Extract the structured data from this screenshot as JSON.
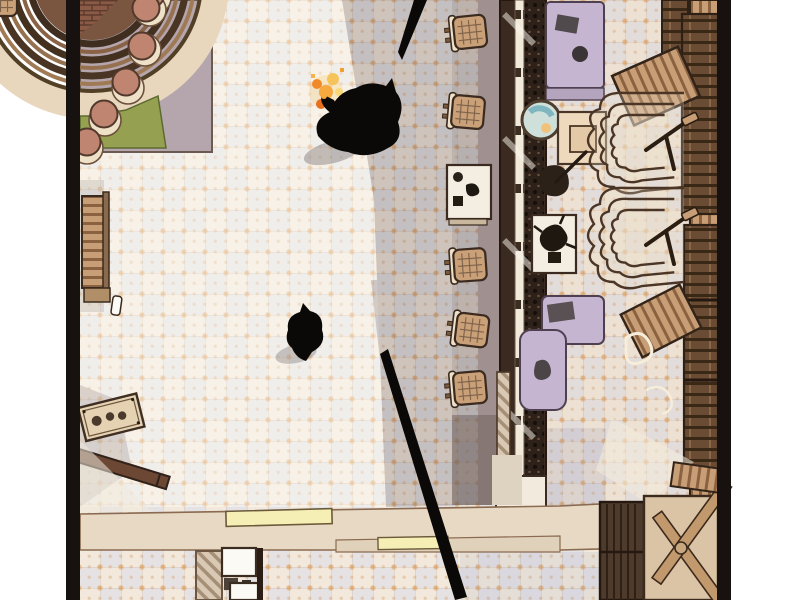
{
  "panel": {
    "alt": "Top-down comic panel of a bar interior: two black-silhouetted figures on a tiled floor, one holding a small flame, a long bar counter with stools, a curved stage with round seats, ornate armchairs, wooden benches, cabinets, and a long black pole crossing the floor"
  },
  "palette": {
    "page-bg": "#ffffff",
    "frame": "#17120f",
    "floor-base": "#f2e9dc",
    "shadow": "#685c60",
    "walkway": "#a09090",
    "carpet": "#b5a6ad",
    "green-mat": "#95a050",
    "stage-stool": "#bf8570",
    "stage-cream": "#efe0c8",
    "brick": "#8a5a46",
    "wood": "#c89e76",
    "wood-dark": "#8a623f",
    "wood-deep": "#6b4734",
    "wall-wood": "#6a4c34",
    "counter-dark": "#3a2a20",
    "counter-mid": "#2e211a",
    "counter-light": "#f1e9da",
    "stool": "#c9a078",
    "lavender": "#c6b5d0",
    "band": "#e7d9c3",
    "slat-yellow": "#f5eeb5",
    "white": "#fcfaf5",
    "ink": "#0b0907",
    "flame-orange": "#f08a28",
    "flame-yellow": "#fad87a",
    "teal": "#7fb6c0"
  },
  "scene": {
    "labels": {
      "floor": "patterned tile floor",
      "shadow": "large cast shadow across the floor",
      "stage": "curved corner stage with round stools",
      "left_bench": "slatted bench along left wall",
      "control_panel": "tilted panel with knobs",
      "plank": "fallen wooden plank",
      "bar_counter": "long bar counter with bottle rack",
      "bar_stools": "bar stools with cross-hatched seats",
      "service_table_left": "service table with kettle and cups",
      "service_table_right": "table with potted plant",
      "sink": "round basin behind the counter",
      "side_table": "square side table",
      "lavender_bench_top": "lavender banquette (top)",
      "lavender_bench_mid": "lavender banquette (middle)",
      "armchair_1": "ornate scalloped armchair",
      "armchair_2": "ornate scalloped armchair",
      "tilted_bench_1": "tilted slatted bench",
      "tilted_bench_2": "tilted slatted bench",
      "wall_cabinets": "dark wooden cabinets along right wall",
      "bottom_wall": "lower wall band with light slats",
      "light_slat_1": "pale yellow light slat",
      "light_slat_2": "pale yellow light slat",
      "hatch_door": "hatched doorway section",
      "white_panels": "white counter hatch panels",
      "slat_door": "dark slatted door",
      "xbrace_table": "cross-braced table top",
      "pole": "long black pole",
      "pole_tip": "black pole tip",
      "figure_flame": "silhouetted figure holding a flame",
      "figure_small": "second silhouetted figure",
      "flame": "small orange flame with sparks"
    },
    "counts": {
      "stage_stools": 6,
      "bar_stools": 5,
      "armchairs": 2,
      "tilted_benches": 2,
      "light_slats": 2,
      "figures": 2
    }
  }
}
